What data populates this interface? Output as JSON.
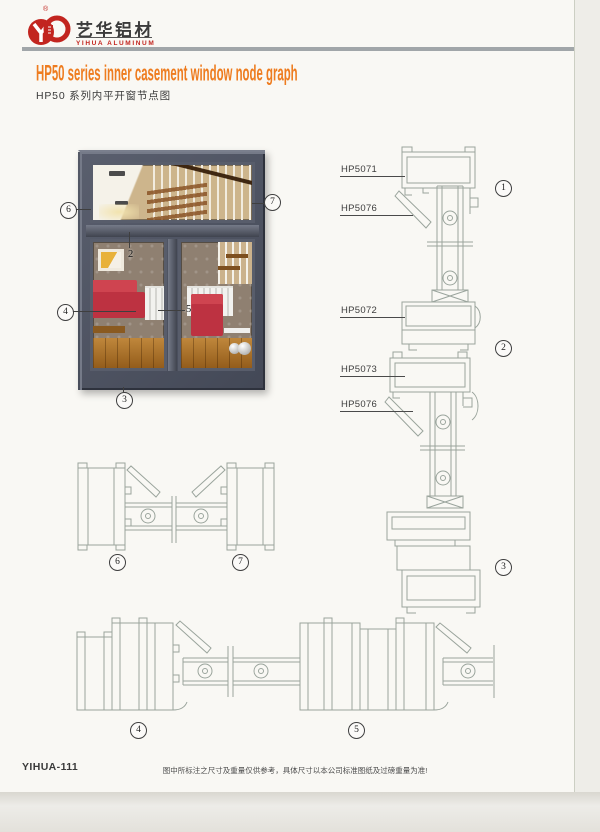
{
  "brand": {
    "logo_cn": "艺华铝材",
    "logo_en": "YIHUA ALUMINUM",
    "registered": "®"
  },
  "title": {
    "en": "HP50 series inner casement window node graph",
    "cn": "HP50 系列内平开窗节点图"
  },
  "figure_callouts": {
    "n2": "2",
    "n3": "3",
    "n4": "4",
    "n5": "5",
    "n6": "6",
    "n7": "7"
  },
  "profiles": {
    "labels": [
      "HP5071",
      "HP5076",
      "HP5072",
      "HP5073",
      "HP5076"
    ]
  },
  "nodes": {
    "1": "1",
    "2": "2",
    "3": "3",
    "4": "4",
    "5": "5",
    "6": "6",
    "7": "7"
  },
  "footer": {
    "page_code": "YIHUA-111",
    "disclaimer": "图中所标注之尺寸及重量仅供参考，具体尺寸以本公司标准图纸及过磅重量为准!"
  },
  "colors": {
    "accent_orange": "#ee7c1f",
    "brand_red": "#c2251f",
    "divider_gray": "#a1a6a9",
    "drawing_line": "#9aa49c",
    "frame_dark": "#4d5261",
    "label_text": "#3d3d3d"
  }
}
